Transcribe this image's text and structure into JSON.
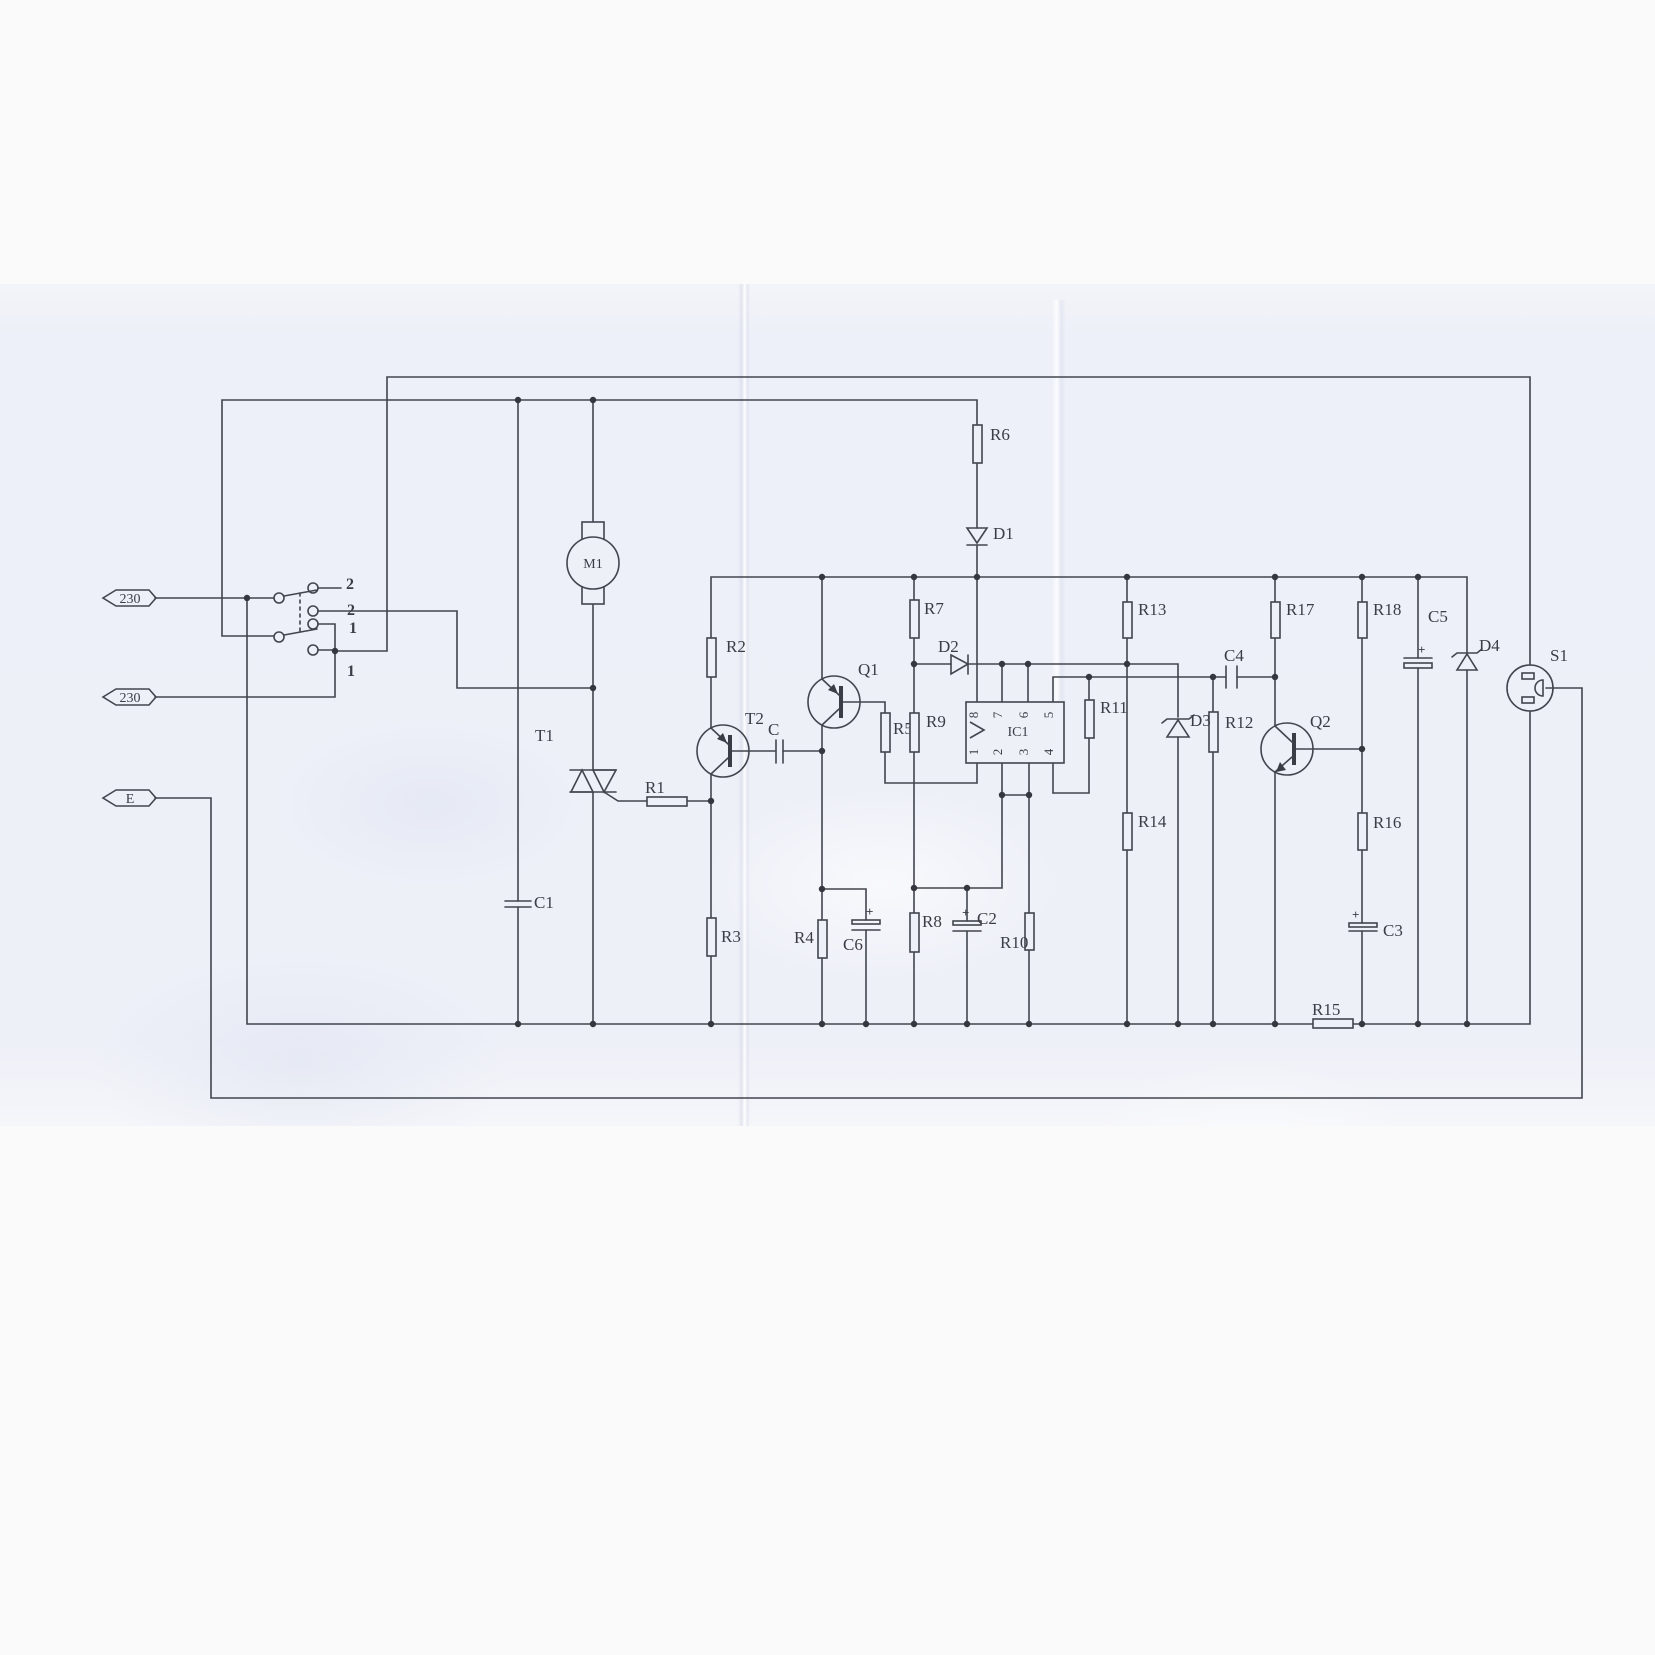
{
  "page": {
    "kind": "scanned circuit schematic",
    "paper_color": "#eef0f8",
    "ink_color": "#3a3d45"
  },
  "connectors": {
    "live_top": "230",
    "live_bottom": "230",
    "earth": "E"
  },
  "mode_switch": {
    "throw_labels": [
      "2",
      "2",
      "1",
      "1"
    ]
  },
  "polarity_mark": "+",
  "ic1": {
    "label": "IC1",
    "pins_top": [
      "8",
      "7",
      "6",
      "5"
    ],
    "pins_bottom": [
      "1",
      "2",
      "3",
      "4"
    ]
  },
  "parts": {
    "M1": "M1",
    "T1": "T1",
    "T2": "T2",
    "Q1": "Q1",
    "Q2": "Q2",
    "S1": "S1",
    "C": "C",
    "C1": "C1",
    "C2": "C2",
    "C3": "C3",
    "C4": "C4",
    "C5": "C5",
    "C6": "C6",
    "D1": "D1",
    "D2": "D2",
    "D3": "D3",
    "D4": "D4",
    "R1": "R1",
    "R2": "R2",
    "R3": "R3",
    "R4": "R4",
    "R5": "R5",
    "R6": "R6",
    "R7": "R7",
    "R8": "R8",
    "R9": "R9",
    "R10": "R10",
    "R11": "R11",
    "R12": "R12",
    "R13": "R13",
    "R14": "R14",
    "R15": "R15",
    "R16": "R16",
    "R17": "R17",
    "R18": "R18"
  }
}
